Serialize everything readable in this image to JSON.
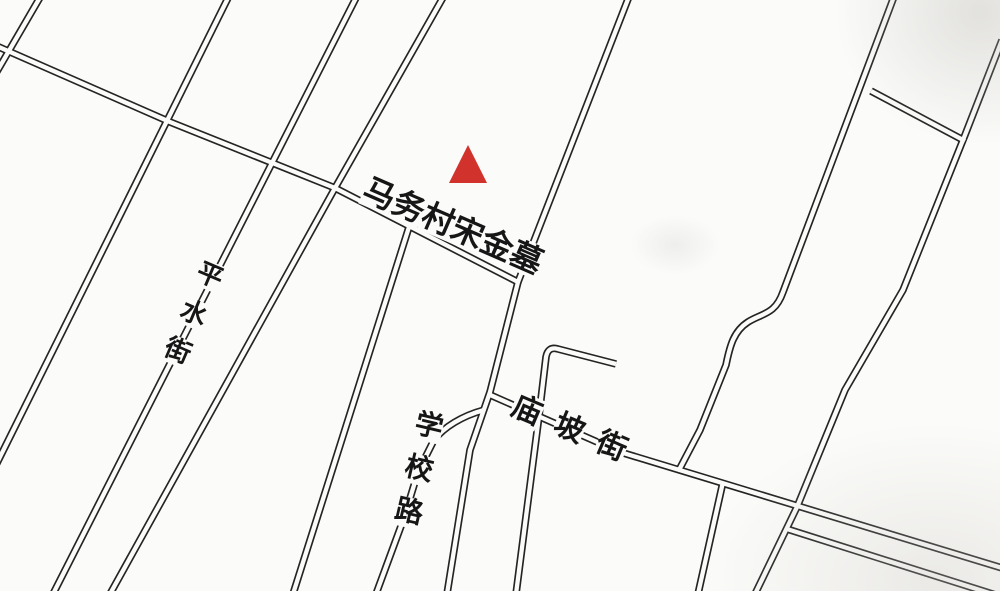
{
  "map": {
    "site": {
      "label": "马务村宋金墓"
    },
    "marker": {
      "shape": "triangle",
      "color": "#d2322c"
    },
    "streets": [
      {
        "id": "pingshui-street",
        "name": "平水街"
      },
      {
        "id": "xuexiao-road",
        "name": "学校路"
      },
      {
        "id": "miaopo-street",
        "name": "庙坡街"
      }
    ],
    "colors": {
      "paper": "#fbfbf9",
      "ink": "#242424"
    }
  }
}
